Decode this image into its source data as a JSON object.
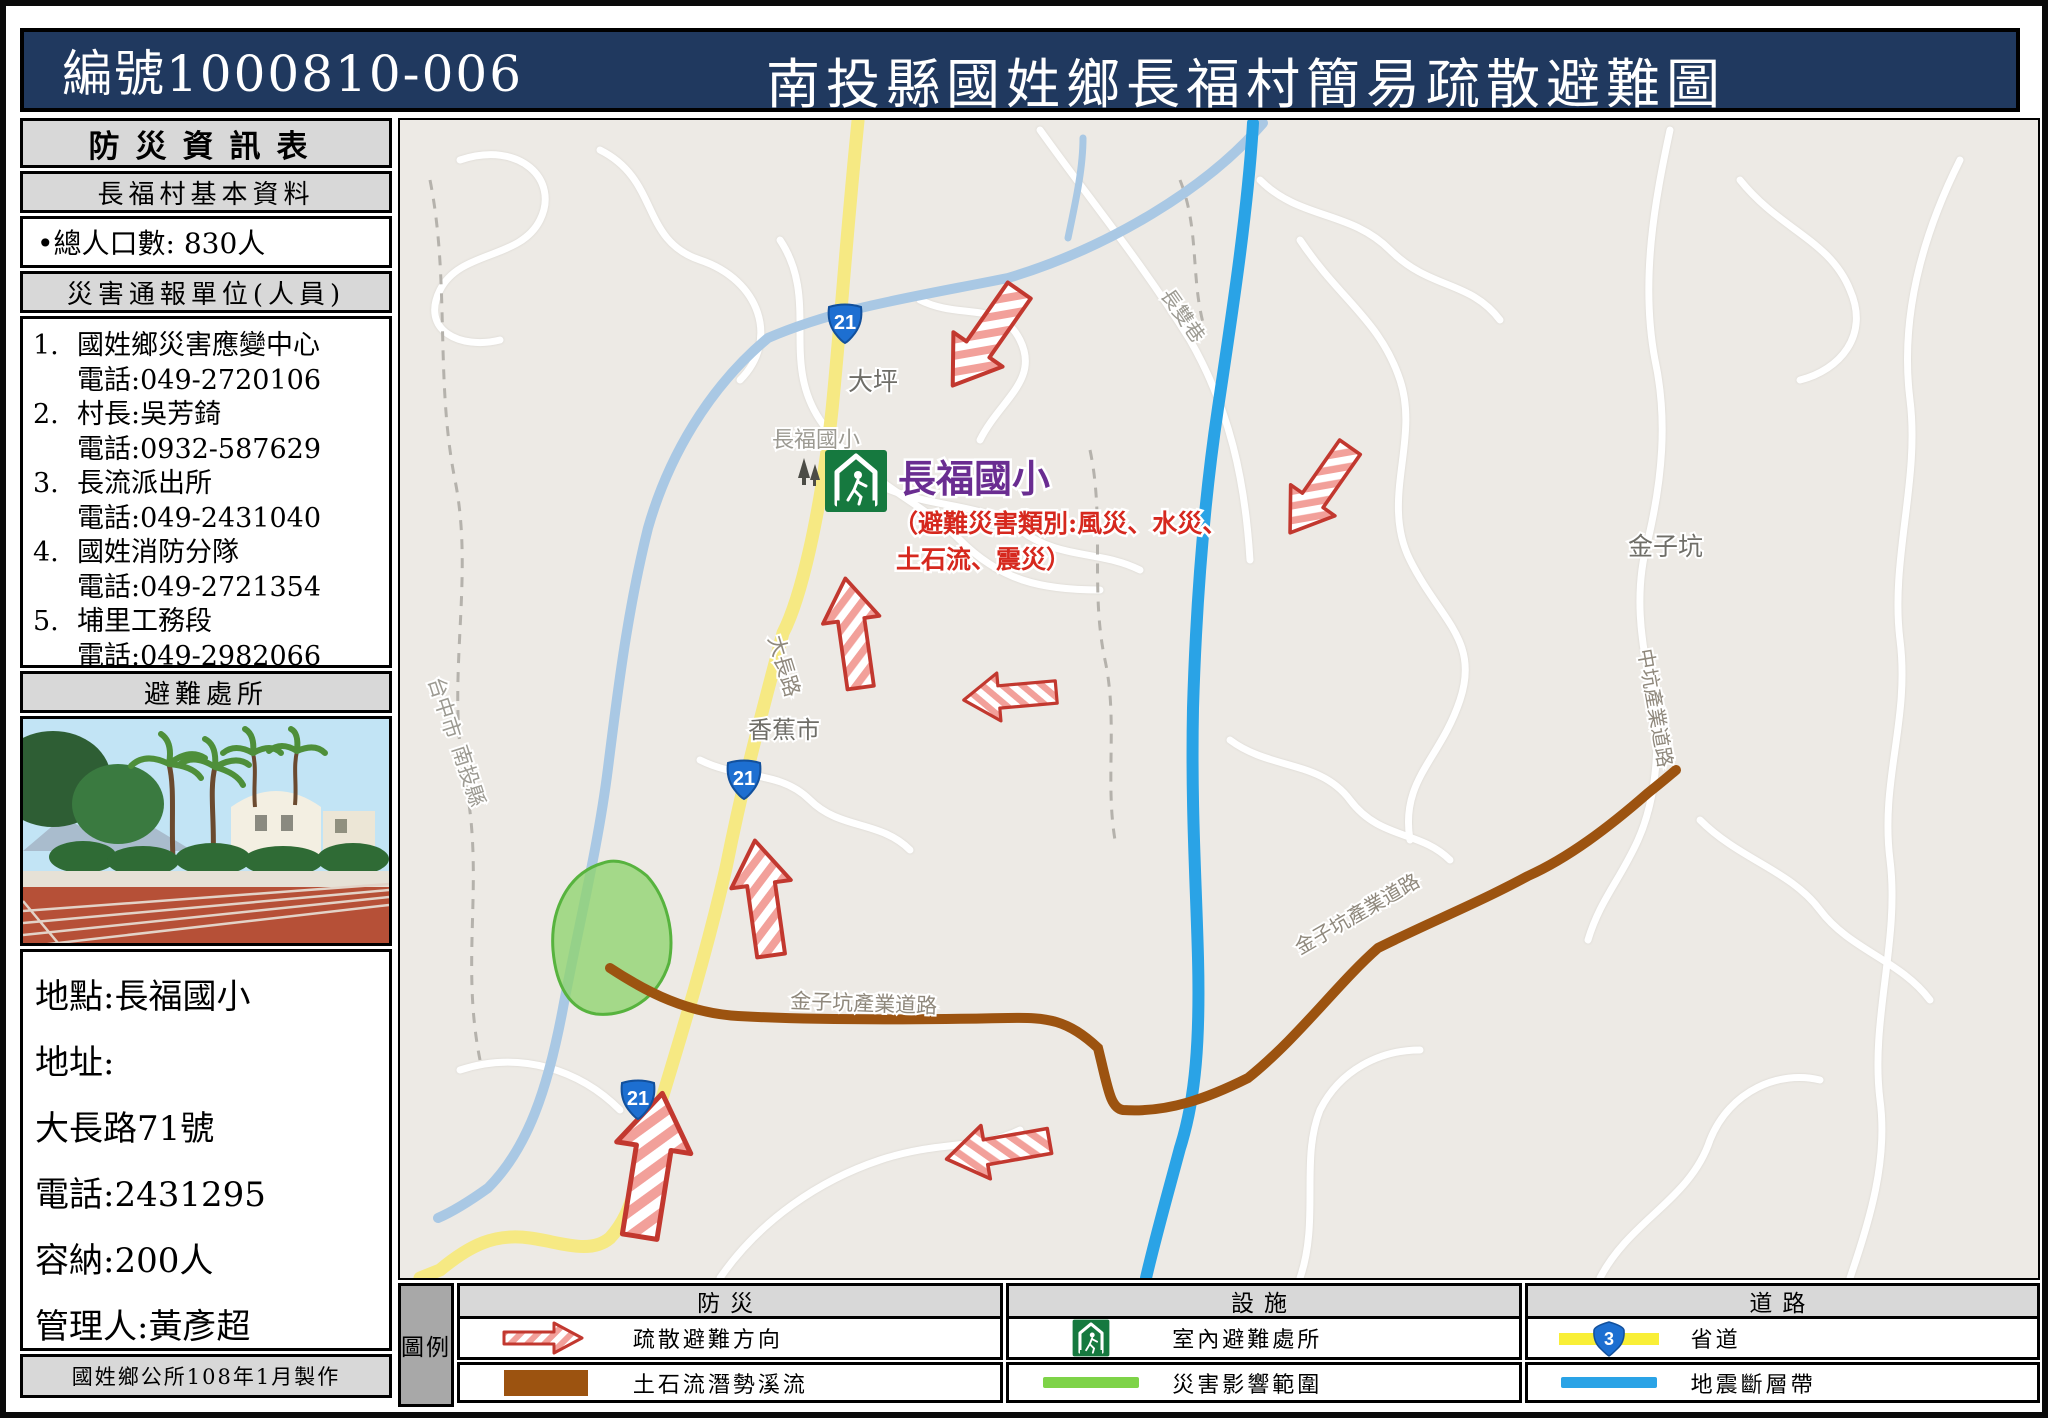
{
  "header": {
    "doc_number": "編號1000810-006",
    "title": "南投縣國姓鄉長福村簡易疏散避難圖"
  },
  "sidebar": {
    "title": "防災資訊表",
    "basic_info_header": "長福村基本資料",
    "population": "•總人口數: 830人",
    "report_units_header": "災害通報單位(人員)",
    "report_units": [
      {
        "no": "1.",
        "name": "國姓鄉災害應變中心",
        "phone": "電話:049-2720106"
      },
      {
        "no": "2.",
        "name": "村長:吳芳錡",
        "phone": "電話:0932-587629"
      },
      {
        "no": "3.",
        "name": "長流派出所",
        "phone": "電話:049-2431040"
      },
      {
        "no": "4.",
        "name": "國姓消防分隊",
        "phone": "電話:049-2721354"
      },
      {
        "no": "5.",
        "name": "埔里工務段",
        "phone": "電話:049-2982066"
      }
    ],
    "shelter_header": "避難處所",
    "shelter_photo": "chang-fu-elementary-school-photo",
    "shelter_info": {
      "location": "地點:長福國小",
      "address_label": "地址:",
      "address": "大長路71號",
      "phone": "電話:2431295",
      "capacity": "容納:200人",
      "manager": "管理人:黃彥超"
    },
    "footer": "國姓鄉公所108年1月製作"
  },
  "map": {
    "route_shield": "21",
    "place_labels": {
      "changshuang_lane": "長雙巷",
      "daping": "大坪",
      "changfu_elementary_gray": "長福國小",
      "taichung_city": "台中市",
      "nantou_county": "南投縣",
      "dachang_road": "大長路",
      "banana_market": "香蕉市",
      "jinzikeng": "金子坑",
      "zhongkeng_industrial_road": "中坑產業道路",
      "jinzikeng_industrial_road": "金子坑產業道路",
      "jinzikeng_industrial_road_2": "金子坑產業道路"
    },
    "shelter_marker": {
      "name": "長福國小",
      "hazard_note_line1": "（避難災害類別:風災、水災、",
      "hazard_note_line2": "土石流、震災）"
    }
  },
  "legend": {
    "key_label": "圖例",
    "columns": [
      {
        "header": "防災",
        "rows": [
          {
            "icon": "evacuation-arrow",
            "label": "疏散避難方向"
          },
          {
            "icon": "debris-flow-line",
            "label": "土石流潛勢溪流"
          }
        ]
      },
      {
        "header": "設施",
        "rows": [
          {
            "icon": "indoor-shelter",
            "label": "室內避難處所"
          },
          {
            "icon": "impact-area-line",
            "label": "災害影響範圍"
          }
        ]
      },
      {
        "header": "道路",
        "rows": [
          {
            "icon": "provincial-route",
            "label": "省道",
            "shield": "3"
          },
          {
            "icon": "fault-line",
            "label": "地震斷層帶"
          }
        ]
      }
    ]
  },
  "colors": {
    "header_bg": "#20395f",
    "route_yellow": "#f9ef97",
    "fault_blue": "#2aa3e6",
    "debris_brown": "#9c5310",
    "impact_green": "#8fd470",
    "arrow_red": "#c2382f",
    "school_purple": "#6a2d91",
    "hazard_red": "#d6281e",
    "shelter_green": "#16793f"
  }
}
